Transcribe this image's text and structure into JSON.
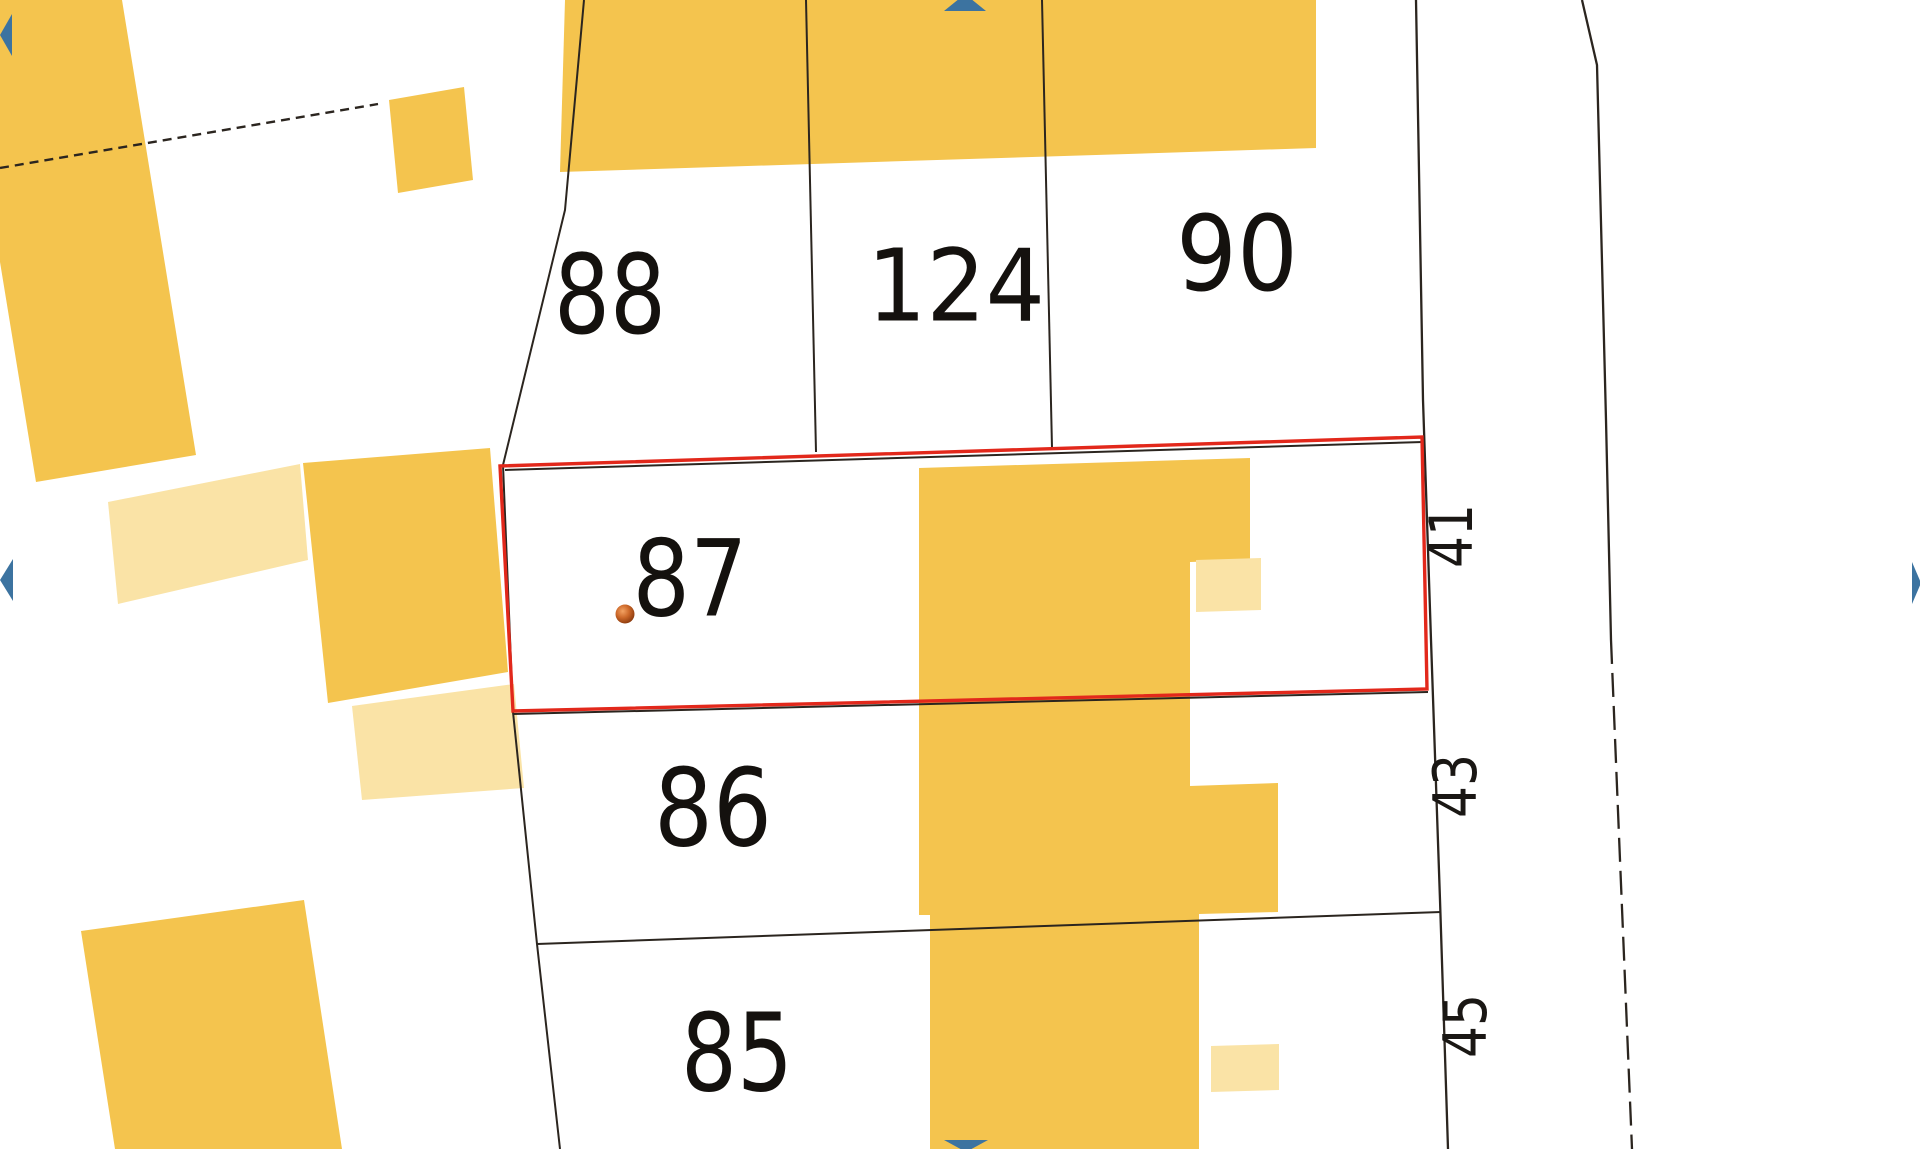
{
  "canvas": {
    "width": 1920,
    "height": 1149,
    "background": "#ffffff"
  },
  "colors": {
    "building": "#F4C44E",
    "building_light": "#FAE3A6",
    "boundary_line": "#2B251F",
    "selection_red": "#E2281B",
    "pan_arrow_blue": "#3C73A0",
    "label_black": "#14110e"
  },
  "map": {
    "buildings": [
      {
        "name": "building-top-left",
        "light": false,
        "points": [
          [
            0,
            0
          ],
          [
            122,
            0
          ],
          [
            196,
            455
          ],
          [
            36,
            482
          ],
          [
            0,
            262
          ]
        ]
      },
      {
        "name": "building-small-square",
        "light": false,
        "points": [
          [
            389,
            100
          ],
          [
            464,
            87
          ],
          [
            473,
            180
          ],
          [
            398,
            193
          ]
        ]
      },
      {
        "name": "building-annex-left-light",
        "light": true,
        "points": [
          [
            108,
            502
          ],
          [
            300,
            464
          ],
          [
            308,
            560
          ],
          [
            118,
            604
          ]
        ]
      },
      {
        "name": "building-mid-left",
        "light": false,
        "points": [
          [
            303,
            463
          ],
          [
            490,
            448
          ],
          [
            508,
            672
          ],
          [
            328,
            703
          ]
        ]
      },
      {
        "name": "building-annex-mid-light",
        "light": true,
        "points": [
          [
            352,
            706
          ],
          [
            514,
            684
          ],
          [
            524,
            788
          ],
          [
            362,
            800
          ]
        ]
      },
      {
        "name": "building-bottom-left",
        "light": false,
        "points": [
          [
            81,
            931
          ],
          [
            304,
            900
          ],
          [
            342,
            1149
          ],
          [
            115,
            1149
          ]
        ]
      },
      {
        "name": "building-top-band",
        "light": false,
        "points": [
          [
            565,
            0
          ],
          [
            1316,
            0
          ],
          [
            1316,
            148
          ],
          [
            560,
            172
          ]
        ]
      },
      {
        "name": "building-central-block",
        "light": false,
        "points": [
          [
            919,
            468
          ],
          [
            1250,
            458
          ],
          [
            1250,
            560
          ],
          [
            1190,
            562
          ],
          [
            1190,
            786
          ],
          [
            1278,
            783
          ],
          [
            1278,
            912
          ],
          [
            1199,
            914
          ],
          [
            1199,
            1149
          ],
          [
            930,
            1149
          ],
          [
            930,
            915
          ],
          [
            919,
            915
          ]
        ]
      },
      {
        "name": "building-central-annex-light",
        "light": true,
        "points": [
          [
            1196,
            560
          ],
          [
            1261,
            558
          ],
          [
            1261,
            610
          ],
          [
            1196,
            612
          ]
        ]
      },
      {
        "name": "building-bottom-annex-light",
        "light": true,
        "points": [
          [
            1211,
            1046
          ],
          [
            1279,
            1044
          ],
          [
            1279,
            1090
          ],
          [
            1211,
            1092
          ]
        ]
      }
    ],
    "boundaries": [
      {
        "name": "boundary-left-parcels",
        "points": [
          [
            584,
            0
          ],
          [
            565,
            210
          ],
          [
            503,
            465
          ],
          [
            513,
            712
          ],
          [
            537,
            944
          ],
          [
            560,
            1149
          ]
        ],
        "width": 2
      },
      {
        "name": "boundary-parcel87-top",
        "points": [
          [
            505,
            470
          ],
          [
            1423,
            442
          ]
        ],
        "width": 2
      },
      {
        "name": "boundary-parcel87-bottom",
        "points": [
          [
            513,
            714
          ],
          [
            1428,
            692
          ]
        ],
        "width": 2
      },
      {
        "name": "boundary-parcel86-85",
        "points": [
          [
            537,
            944
          ],
          [
            1441,
            912
          ]
        ],
        "width": 2
      },
      {
        "name": "boundary-88-124",
        "points": [
          [
            806,
            0
          ],
          [
            816,
            452
          ]
        ],
        "width": 2
      },
      {
        "name": "boundary-124-90",
        "points": [
          [
            1042,
            0
          ],
          [
            1052,
            448
          ]
        ],
        "width": 2
      },
      {
        "name": "boundary-street-west",
        "points": [
          [
            1416,
            0
          ],
          [
            1423,
            400
          ],
          [
            1431,
            640
          ],
          [
            1440,
            900
          ],
          [
            1448,
            1149
          ]
        ],
        "width": 2.3
      },
      {
        "name": "road-edge-solid",
        "points": [
          [
            1582,
            0
          ],
          [
            1597,
            65
          ],
          [
            1606,
            420
          ],
          [
            1611,
            640
          ]
        ],
        "width": 2.3
      },
      {
        "name": "road-edge-dashed",
        "points": [
          [
            1611,
            640
          ],
          [
            1620,
            860
          ],
          [
            1632,
            1149
          ]
        ],
        "width": 2.3,
        "dash": "24 9"
      },
      {
        "name": "boundary-dashed-top-left",
        "points": [
          [
            0,
            168
          ],
          [
            378,
            104
          ]
        ],
        "width": 2.4,
        "dash": "9 6"
      }
    ],
    "selection": {
      "name": "selected-parcel-87-outline",
      "points": [
        [
          500,
          466
        ],
        [
          1422,
          437
        ],
        [
          1427,
          689
        ],
        [
          513,
          711
        ]
      ],
      "stroke_width": 3.4
    },
    "marker": {
      "cx": 625,
      "cy": 614,
      "r": 9.5
    },
    "parcel_labels": [
      {
        "number": "88",
        "x": 610,
        "y": 295,
        "size": 110,
        "tl": 112
      },
      {
        "number": "124",
        "x": 956,
        "y": 286,
        "size": 100,
        "tl": 178
      },
      {
        "number": "90",
        "x": 1237,
        "y": 254,
        "size": 104,
        "tl": 122
      },
      {
        "number": "87",
        "x": 690,
        "y": 579,
        "size": 106,
        "tl": 115
      },
      {
        "number": "86",
        "x": 713,
        "y": 809,
        "size": 108,
        "tl": 118
      },
      {
        "number": "85",
        "x": 737,
        "y": 1054,
        "size": 108,
        "tl": 112
      }
    ],
    "street_labels": [
      {
        "number": "41",
        "x": 1452,
        "y": 536,
        "size": 60,
        "tl": 64,
        "rotation": -90
      },
      {
        "number": "43",
        "x": 1456,
        "y": 786,
        "size": 60,
        "tl": 64,
        "rotation": -90
      },
      {
        "number": "45",
        "x": 1466,
        "y": 1026,
        "size": 60,
        "tl": 64,
        "rotation": -90
      }
    ],
    "pan_arrows": [
      {
        "name": "pan-up-arrow",
        "points": [
          [
            944,
            11
          ],
          [
            986,
            11
          ],
          [
            965,
            -6
          ]
        ]
      },
      {
        "name": "pan-down-arrow",
        "points": [
          [
            944,
            1140
          ],
          [
            988,
            1140
          ],
          [
            966,
            1152
          ]
        ]
      },
      {
        "name": "pan-left-arrow",
        "points": [
          [
            13,
            559
          ],
          [
            13,
            601
          ],
          [
            0,
            580
          ]
        ]
      },
      {
        "name": "pan-right-arrow",
        "points": [
          [
            1912,
            562
          ],
          [
            1912,
            604
          ],
          [
            1921,
            583
          ]
        ]
      },
      {
        "name": "pan-left-top-arrow",
        "points": [
          [
            12,
            14
          ],
          [
            12,
            56
          ],
          [
            0,
            35
          ]
        ]
      }
    ]
  }
}
